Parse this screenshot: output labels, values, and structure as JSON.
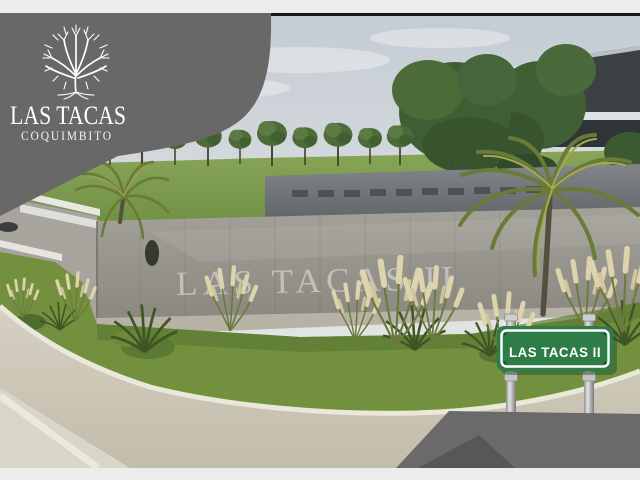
{
  "brand_banner": {
    "title": "LAS TACAS",
    "subtitle": "COQUIMBITO",
    "logo": "tree-icon",
    "background_color": "#686868",
    "text_color": "#ffffff"
  },
  "render": {
    "entrance_wall_text": "LAS TACAS II",
    "street_sign": {
      "label": "LAS TACAS II",
      "plate_color": "#2e7c48",
      "border_color": "#ffffff",
      "text_color": "#ffffff",
      "post_color": "#b9b9b9"
    },
    "scene_colors": {
      "sky": "#c9d0d6",
      "lawn_green": "#7e9c4c",
      "wall_gray": "#9a988f",
      "road_beige": "#cdc7b9"
    }
  },
  "frame": {
    "top_strip_color": "#ececec",
    "separator_color": "#161616",
    "bottom_strip_color": "#ececec",
    "corner_wedge_color": "#6a6a6a",
    "corner_wedge_dark_color": "#575757"
  }
}
